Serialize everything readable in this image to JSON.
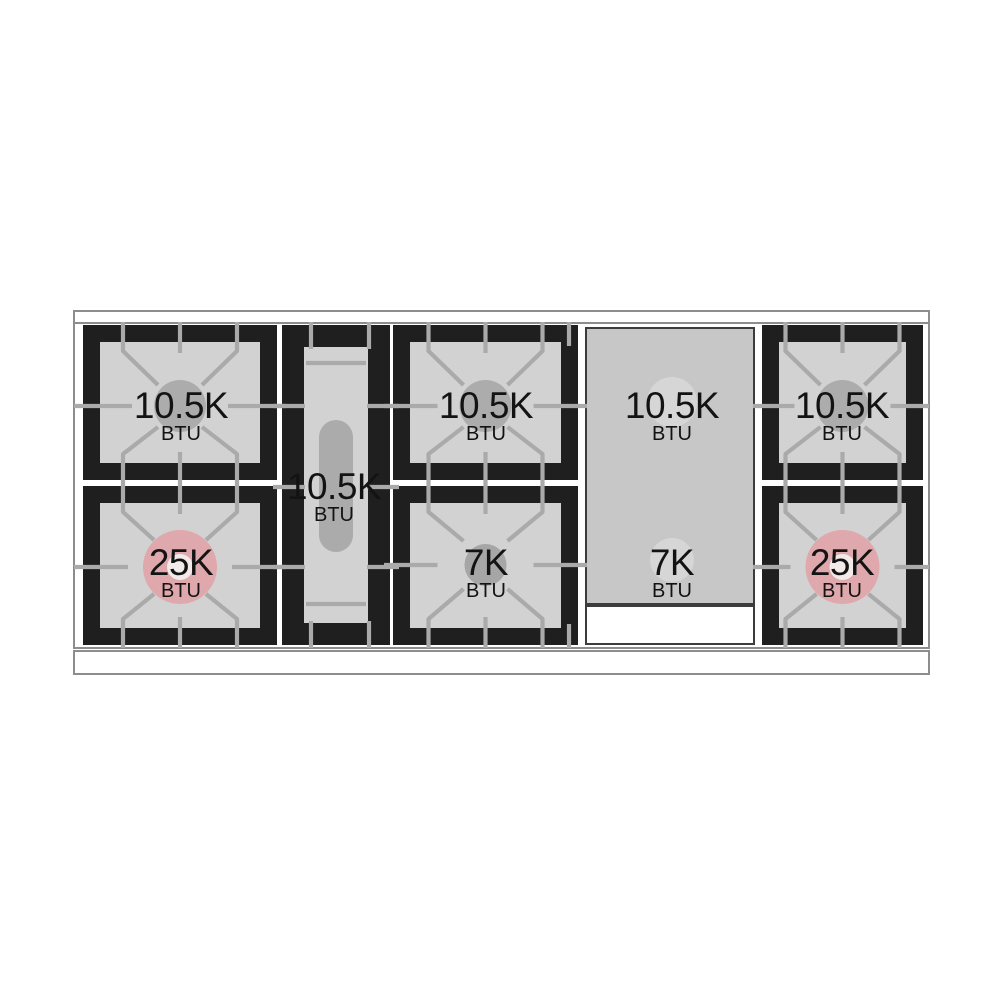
{
  "diagram": {
    "burners": {
      "left_rear": {
        "value": "10.5K",
        "unit": "BTU"
      },
      "left_front": {
        "value": "25K",
        "unit": "BTU"
      },
      "center_oval": {
        "value": "10.5K",
        "unit": "BTU"
      },
      "middle_rear": {
        "value": "10.5K",
        "unit": "BTU"
      },
      "middle_front": {
        "value": "7K",
        "unit": "BTU"
      },
      "griddle_rear": {
        "value": "10.5K",
        "unit": "BTU"
      },
      "griddle_front": {
        "value": "7K",
        "unit": "BTU"
      },
      "right_rear": {
        "value": "10.5K",
        "unit": "BTU"
      },
      "right_front": {
        "value": "25K",
        "unit": "BTU"
      }
    },
    "colors": {
      "frame_black": "#1f1f1f",
      "surface_gray": "#d2d2d2",
      "griddle_gray": "#c7c7c7",
      "grate_line": "#aaaaaa",
      "standard_burner": "#acacac",
      "small_burner": "#a6a6a6",
      "high_output_burner": "#dfa8ac",
      "burner_center_hole": "#f2e9e9",
      "oval_burner": "#ababab",
      "griddle_burner_highlight": "#d6d6d6",
      "outline_gray": "#8d8d8d",
      "text_color": "#131313"
    }
  }
}
